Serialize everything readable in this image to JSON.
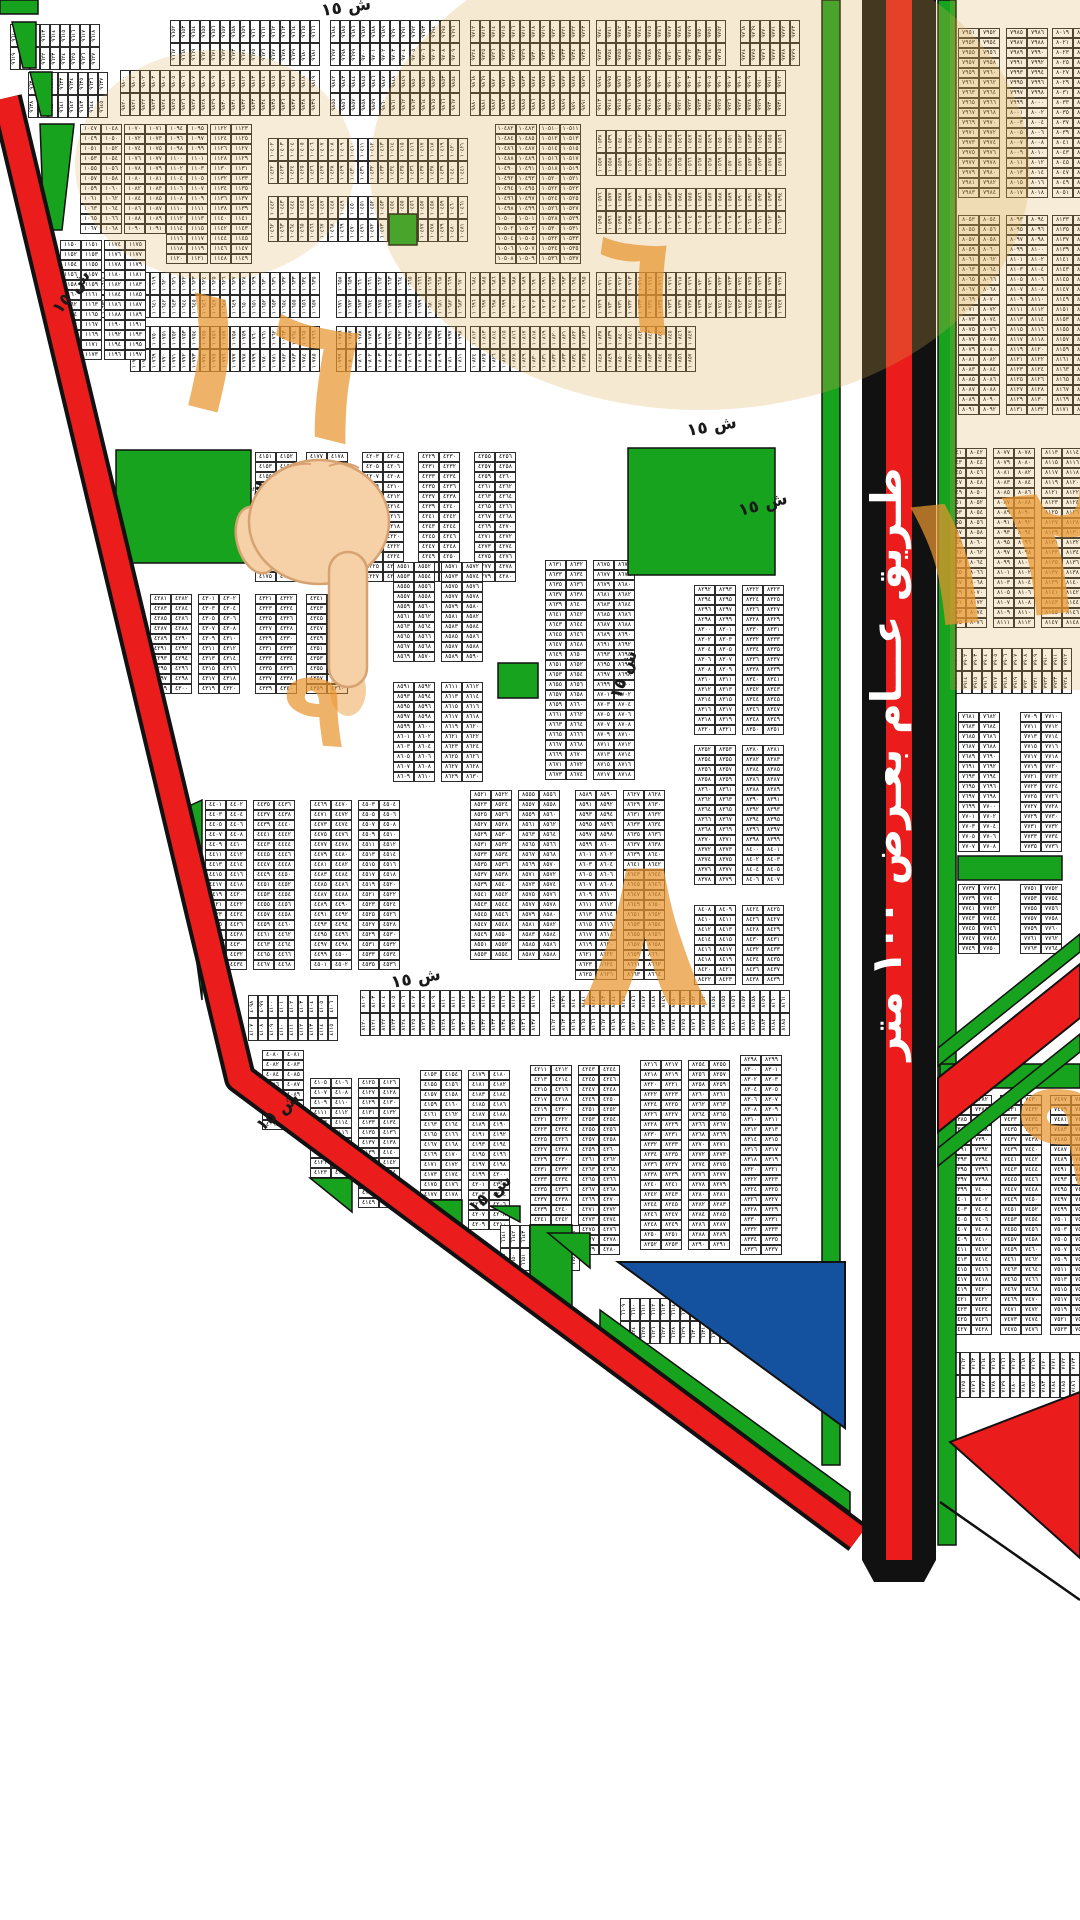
{
  "map": {
    "street_label": "ش ١٥",
    "highway_label": "طـريق عـــام بعـرض ١٠٠ متر",
    "watermarks": {
      "center_big": "٨",
      "right_top": "١٢",
      "top_left": "١٦",
      "top_center": "٦",
      "below_hand": "٩",
      "right_bottom": "٩"
    },
    "colors": {
      "park_green": "#18a31f",
      "road_red": "#ea1c1c",
      "road_black": "#111111",
      "parcel_blue": "#14519f",
      "watermark_orange": "#e8952f",
      "highlight_tan": "#d9a94f",
      "hand_skin": "#f6d0a6"
    },
    "blocks": [
      [
        "h",
        170,
        20,
        15,
        2,
        9652
      ],
      [
        "h",
        330,
        20,
        13,
        2,
        9684
      ],
      [
        "h",
        470,
        20,
        12,
        2,
        9712
      ],
      [
        "h",
        596,
        20,
        13,
        2,
        9740
      ],
      [
        "h",
        740,
        20,
        6,
        2,
        9768
      ],
      [
        "h",
        10,
        24,
        9,
        2,
        9610
      ],
      [
        "h",
        28,
        72,
        8,
        2,
        9630
      ],
      [
        "h",
        120,
        70,
        20,
        2,
        9800
      ],
      [
        "h",
        330,
        70,
        13,
        2,
        9842
      ],
      [
        "h",
        470,
        70,
        12,
        2,
        9868
      ],
      [
        "h",
        596,
        70,
        19,
        2,
        9894
      ],
      [
        "v",
        80,
        124,
        2,
        11,
        1047
      ],
      [
        "v",
        124,
        124,
        2,
        11,
        1070
      ],
      [
        "v",
        166,
        124,
        2,
        14,
        1094
      ],
      [
        "v",
        210,
        124,
        2,
        14,
        1122
      ],
      [
        "h",
        268,
        138,
        20,
        2,
        10402
      ],
      [
        "h",
        268,
        196,
        20,
        2,
        10442
      ],
      [
        "v",
        495,
        124,
        2,
        14,
        10482
      ],
      [
        "v",
        539,
        124,
        2,
        14,
        10510
      ],
      [
        "h",
        596,
        130,
        19,
        2,
        10538
      ],
      [
        "h",
        596,
        188,
        19,
        2,
        10576
      ],
      [
        "h",
        100,
        272,
        22,
        2,
        10614
      ],
      [
        "h",
        336,
        272,
        13,
        2,
        10658
      ],
      [
        "h",
        470,
        272,
        12,
        2,
        10684
      ],
      [
        "h",
        596,
        272,
        19,
        2,
        10710
      ],
      [
        "h",
        130,
        326,
        19,
        2,
        10748
      ],
      [
        "h",
        336,
        326,
        13,
        2,
        10786
      ],
      [
        "h",
        470,
        326,
        12,
        2,
        10812
      ],
      [
        "h",
        596,
        326,
        10,
        2,
        10838
      ],
      [
        "v",
        60,
        240,
        2,
        12,
        1150
      ],
      [
        "v",
        104,
        240,
        2,
        12,
        1174
      ],
      [
        "v",
        255,
        452,
        2,
        13,
        4151
      ],
      [
        "v",
        306,
        452,
        2,
        13,
        4177
      ],
      [
        "v",
        362,
        452,
        2,
        13,
        4203
      ],
      [
        "v",
        418,
        452,
        2,
        13,
        4229
      ],
      [
        "v",
        474,
        452,
        2,
        13,
        4255
      ],
      [
        "v",
        150,
        594,
        2,
        10,
        4281
      ],
      [
        "v",
        198,
        594,
        2,
        10,
        4301
      ],
      [
        "v",
        255,
        594,
        2,
        10,
        4321
      ],
      [
        "v",
        306,
        594,
        2,
        10,
        4341
      ],
      [
        "v",
        393,
        562,
        2,
        10,
        8551
      ],
      [
        "v",
        441,
        562,
        2,
        10,
        8571
      ],
      [
        "v",
        393,
        682,
        2,
        10,
        8591
      ],
      [
        "v",
        441,
        682,
        2,
        10,
        8611
      ],
      [
        "v",
        545,
        560,
        2,
        22,
        8631
      ],
      [
        "v",
        593,
        560,
        2,
        22,
        8675
      ],
      [
        "v",
        694,
        585,
        2,
        15,
        8292
      ],
      [
        "v",
        742,
        585,
        2,
        15,
        8322
      ],
      [
        "v",
        694,
        745,
        2,
        14,
        8352
      ],
      [
        "v",
        742,
        745,
        2,
        14,
        8380
      ],
      [
        "v",
        694,
        905,
        2,
        8,
        8408
      ],
      [
        "v",
        742,
        905,
        2,
        8,
        8424
      ],
      [
        "v",
        205,
        800,
        2,
        17,
        4401
      ],
      [
        "v",
        253,
        800,
        2,
        17,
        4435
      ],
      [
        "v",
        310,
        800,
        2,
        17,
        4469
      ],
      [
        "v",
        358,
        800,
        2,
        17,
        4503
      ],
      [
        "v",
        470,
        790,
        2,
        17,
        8521
      ],
      [
        "v",
        518,
        790,
        2,
        17,
        8555
      ],
      [
        "v",
        575,
        790,
        2,
        19,
        8589
      ],
      [
        "v",
        623,
        790,
        2,
        19,
        8627
      ],
      [
        "h",
        248,
        995,
        9,
        2,
        4098
      ],
      [
        "h",
        360,
        990,
        18,
        2,
        8102
      ],
      [
        "h",
        550,
        990,
        24,
        2,
        8138
      ],
      [
        "v",
        262,
        1050,
        2,
        8,
        4080
      ],
      [
        "v",
        310,
        1078,
        2,
        10,
        4105
      ],
      [
        "v",
        358,
        1078,
        2,
        13,
        4125
      ],
      [
        "v",
        420,
        1070,
        2,
        13,
        4153
      ],
      [
        "v",
        468,
        1070,
        2,
        16,
        4179
      ],
      [
        "v",
        530,
        1065,
        2,
        16,
        4211
      ],
      [
        "v",
        578,
        1065,
        2,
        19,
        4243
      ],
      [
        "v",
        640,
        1060,
        2,
        19,
        8216
      ],
      [
        "v",
        688,
        1060,
        2,
        19,
        8254
      ],
      [
        "v",
        740,
        1055,
        2,
        20,
        8298
      ],
      [
        "h",
        620,
        1298,
        14,
        2,
        6609
      ],
      [
        "h",
        500,
        1225,
        8,
        2,
        6641
      ],
      [
        "v",
        958,
        28,
        2,
        17,
        7951
      ],
      [
        "v",
        1006,
        28,
        2,
        17,
        7985
      ],
      [
        "v",
        1052,
        28,
        2,
        17,
        8019
      ],
      [
        "v",
        958,
        215,
        2,
        20,
        8053
      ],
      [
        "v",
        1006,
        215,
        2,
        20,
        8093
      ],
      [
        "v",
        1052,
        215,
        2,
        20,
        8133
      ],
      [
        "v",
        945,
        448,
        2,
        18,
        8041
      ],
      [
        "v",
        993,
        448,
        2,
        18,
        8077
      ],
      [
        "v",
        1041,
        448,
        2,
        18,
        8113
      ],
      [
        "h",
        952,
        648,
        12,
        2,
        7901
      ],
      [
        "v",
        958,
        712,
        2,
        14,
        7681
      ],
      [
        "v",
        1020,
        712,
        2,
        14,
        7709
      ],
      [
        "v",
        958,
        884,
        2,
        7,
        7737
      ],
      [
        "v",
        1020,
        884,
        2,
        7,
        7751
      ],
      [
        "v",
        950,
        1095,
        2,
        24,
        7381
      ],
      [
        "v",
        1000,
        1095,
        2,
        24,
        7429
      ],
      [
        "v",
        1050,
        1095,
        2,
        24,
        7477
      ],
      [
        "h",
        950,
        1352,
        13,
        2,
        7161
      ]
    ]
  }
}
